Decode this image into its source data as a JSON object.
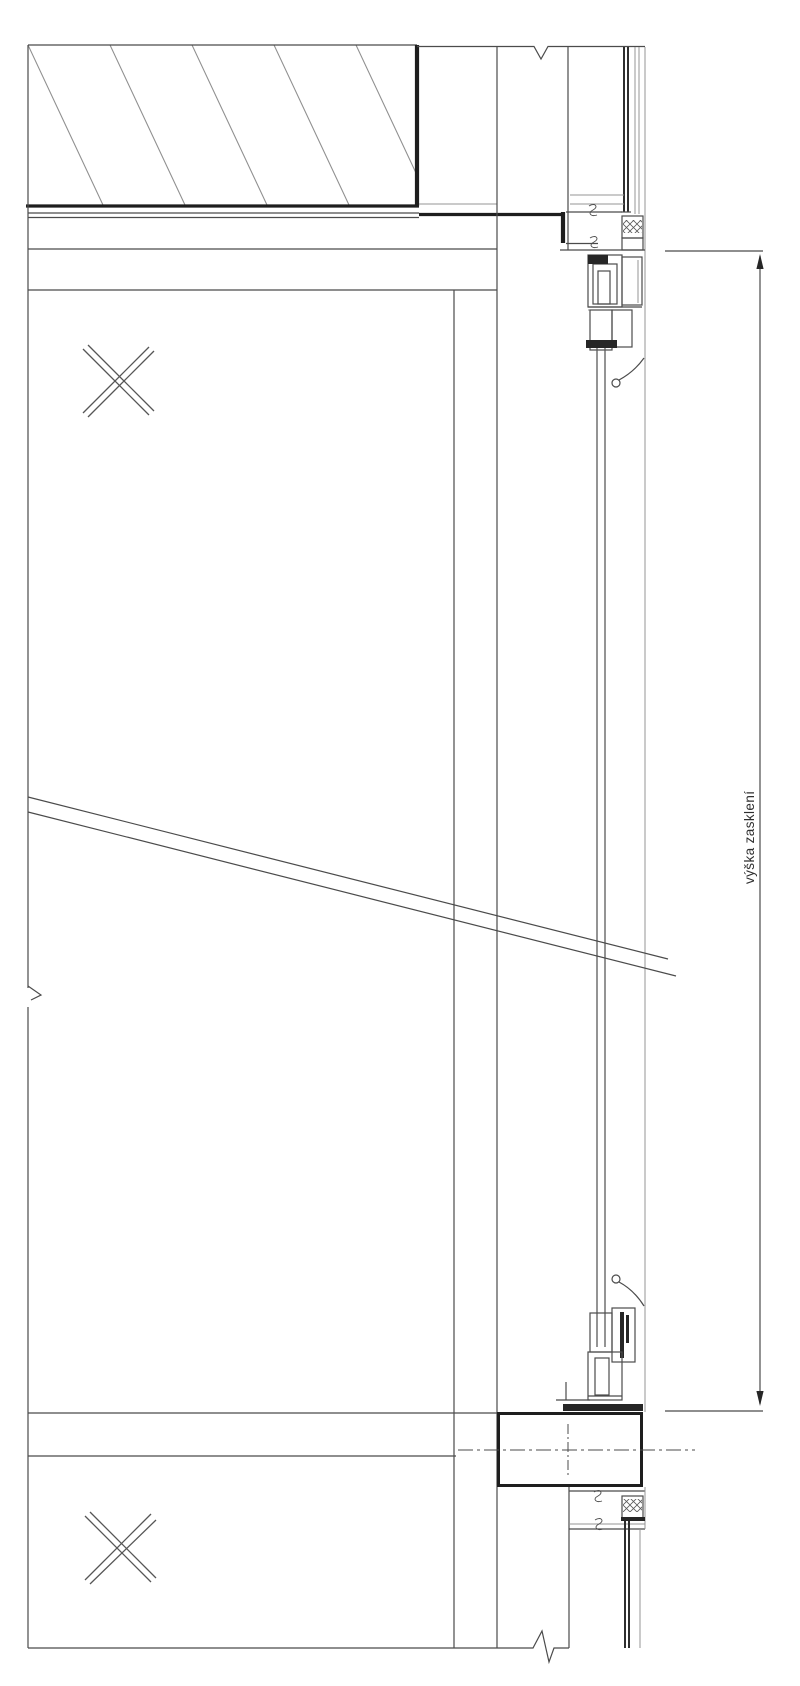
{
  "drawing": {
    "type": "architectural-section-detail",
    "dimension_label": "výška zasklení",
    "colors": {
      "background": "#ffffff",
      "line": "#4b4b4b",
      "line_light": "#949494",
      "line_bold": "#1e1e1e",
      "glass_line": "#5a5a5a",
      "text": "#2f2f2f"
    }
  }
}
